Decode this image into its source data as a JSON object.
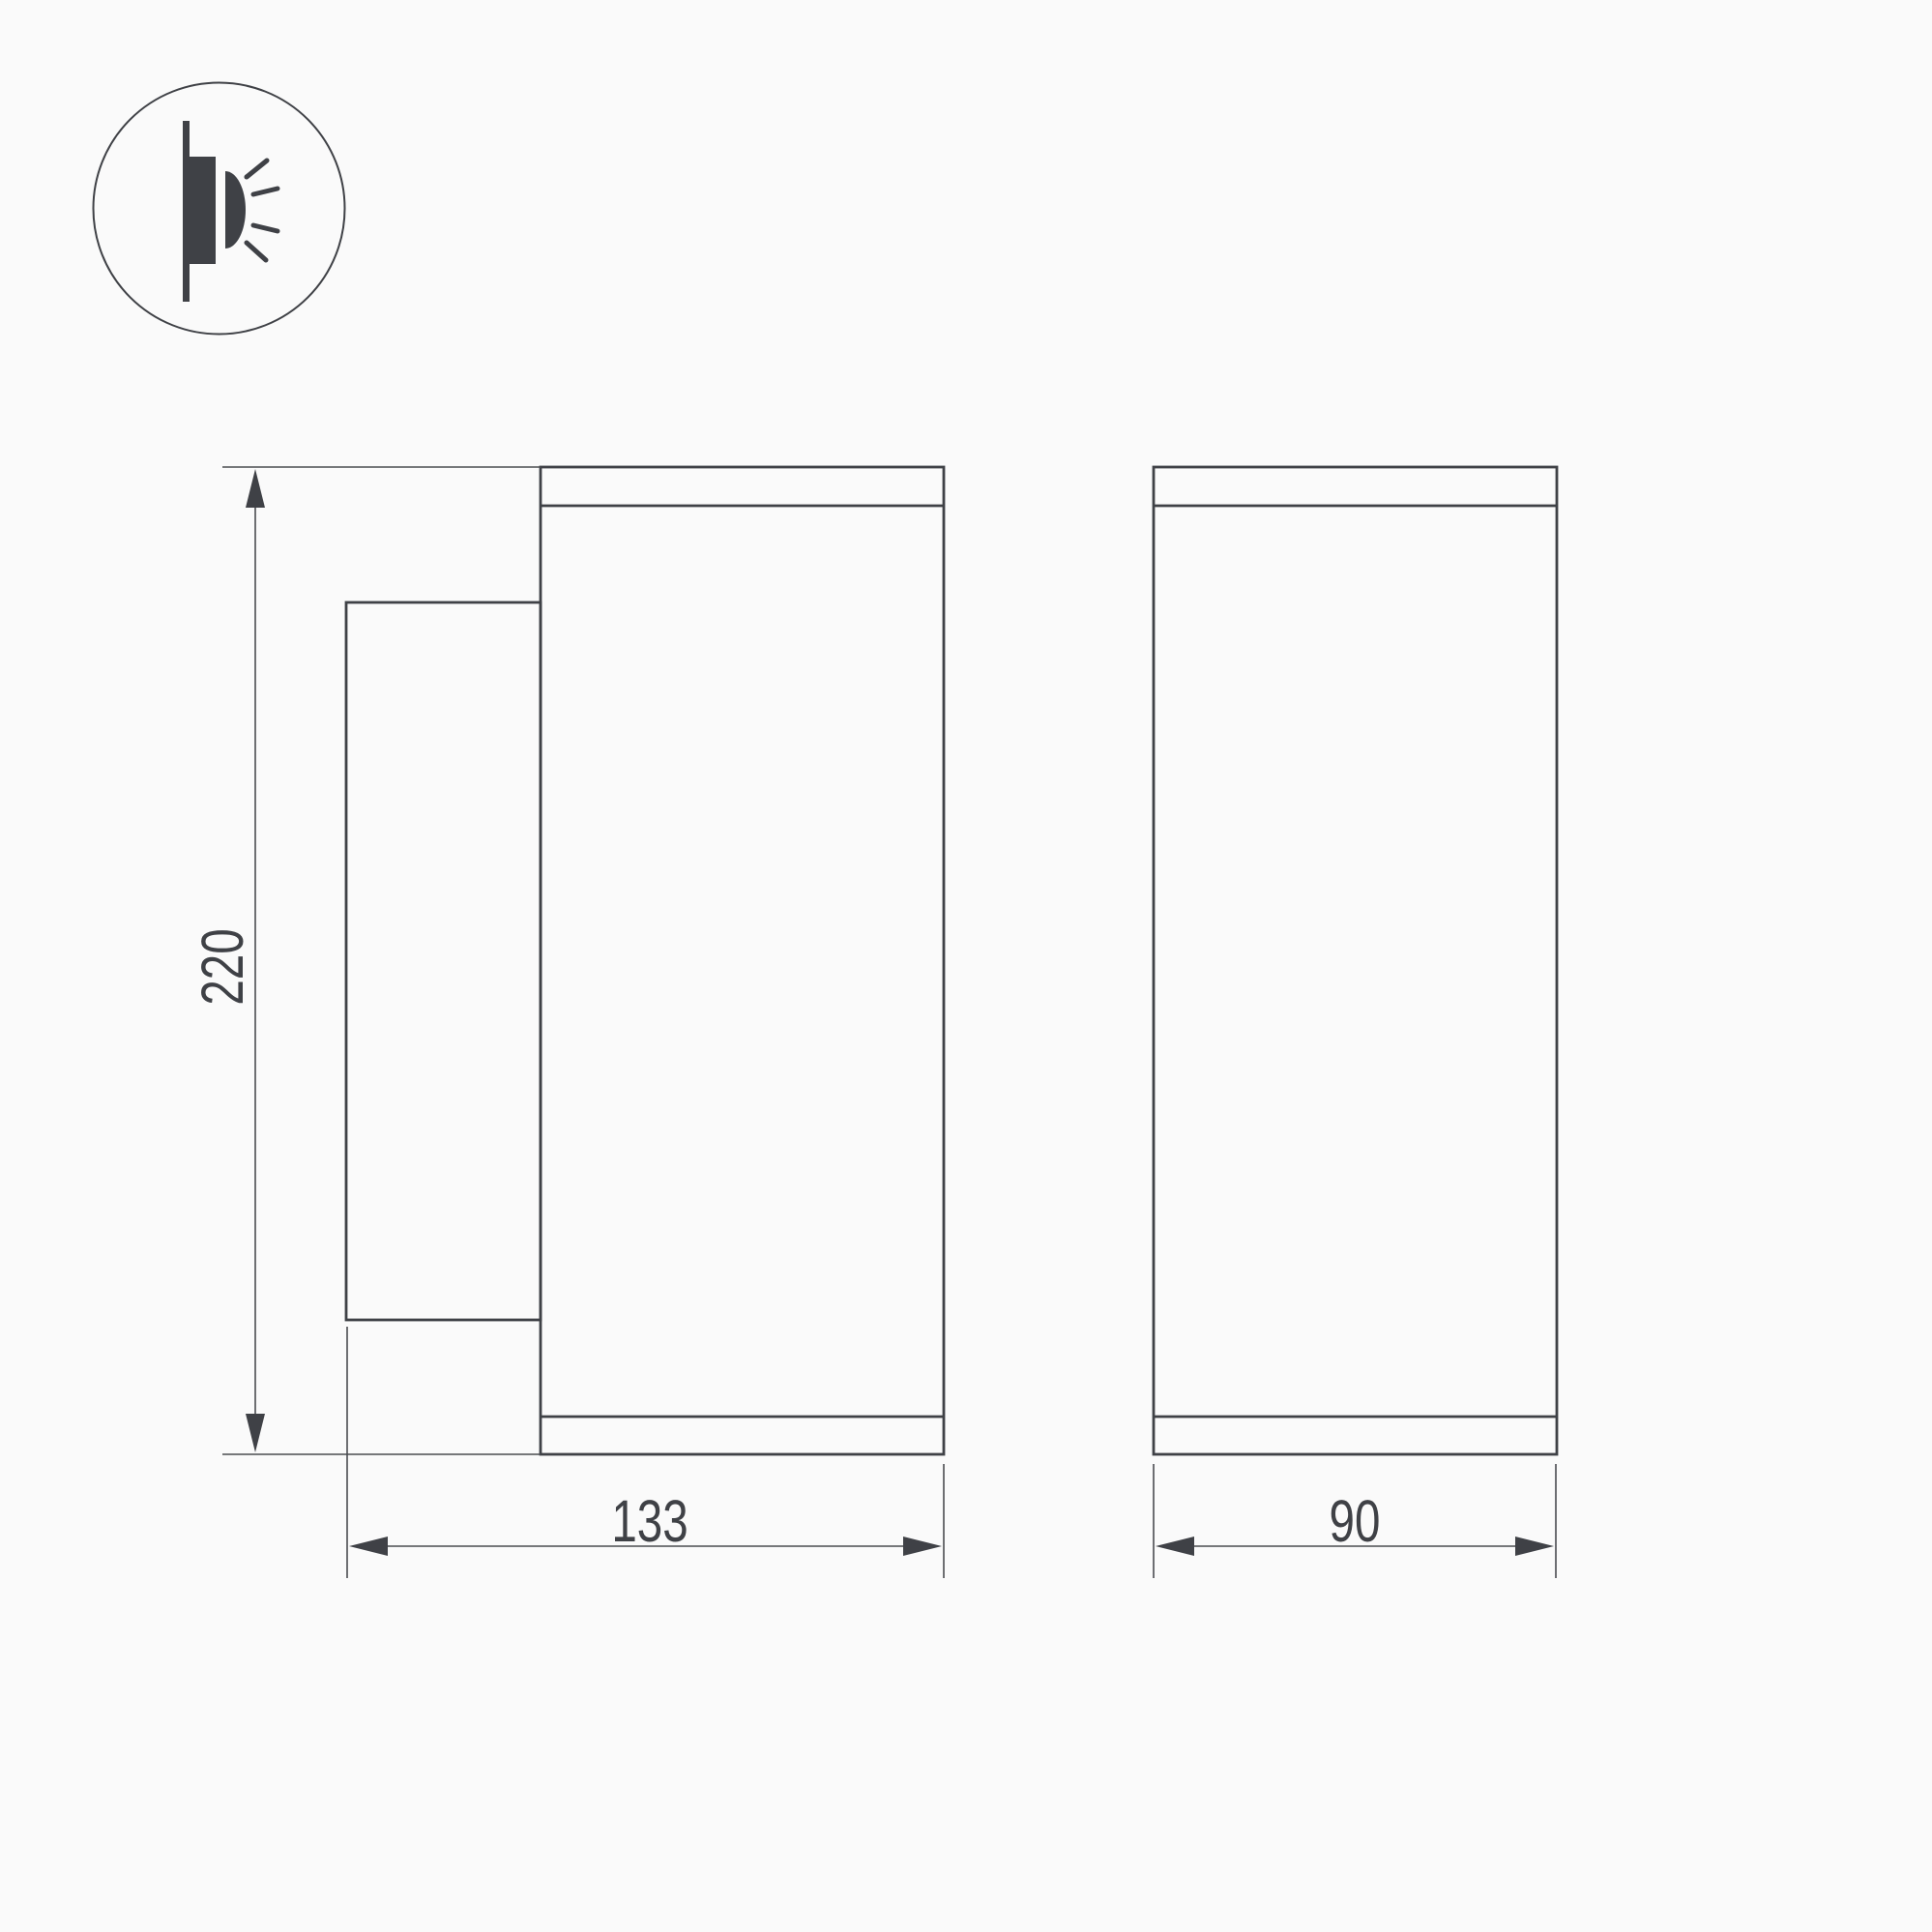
{
  "page": {
    "background_color": "#fafafa",
    "line_color": "#3f4146",
    "text_color": "#3f4146"
  },
  "icon": {
    "name": "wall-mounted-light-icon"
  },
  "dimensions": {
    "height": "220",
    "depth": "133",
    "width": "90"
  }
}
